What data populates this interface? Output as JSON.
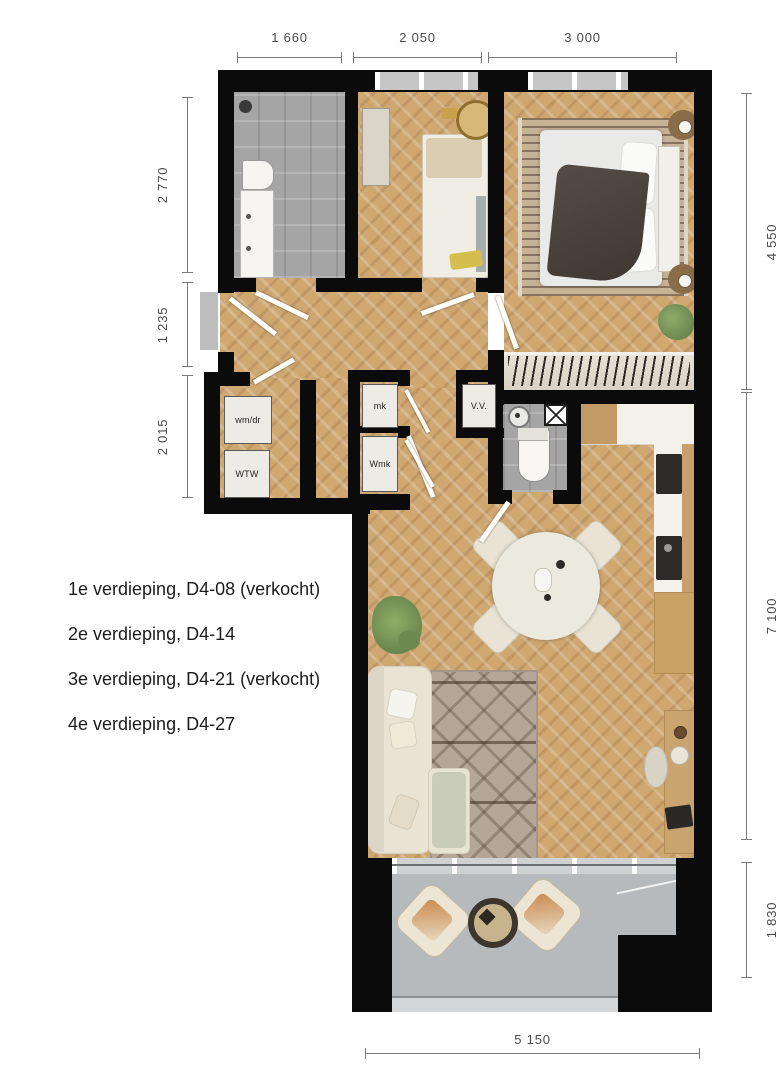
{
  "floor_list": [
    "1e verdieping, D4-08 (verkocht)",
    "2e verdieping, D4-14",
    "3e verdieping, D4-21 (verkocht)",
    "4e verdieping, D4-27"
  ],
  "dimensions": {
    "top": [
      "1 660",
      "2 050",
      "3 000"
    ],
    "left": [
      "2 770",
      "1 235",
      "2 015"
    ],
    "right": [
      "4 550",
      "7 100",
      "1 830"
    ],
    "bottom": [
      "5 150"
    ]
  },
  "closet_labels": {
    "washer_dryer": "wm/dr",
    "heat_recovery": "WTW",
    "meter_cupboard": "mk",
    "water_meter": "Wmk",
    "ventilation": "V.V."
  },
  "colors": {
    "wall": "#0b0b0b",
    "wood_floor": "#cfa771",
    "tile_floor": "#a5a5a5",
    "balcony_floor": "#b7babc",
    "accent_gold": "#b08d3e"
  }
}
